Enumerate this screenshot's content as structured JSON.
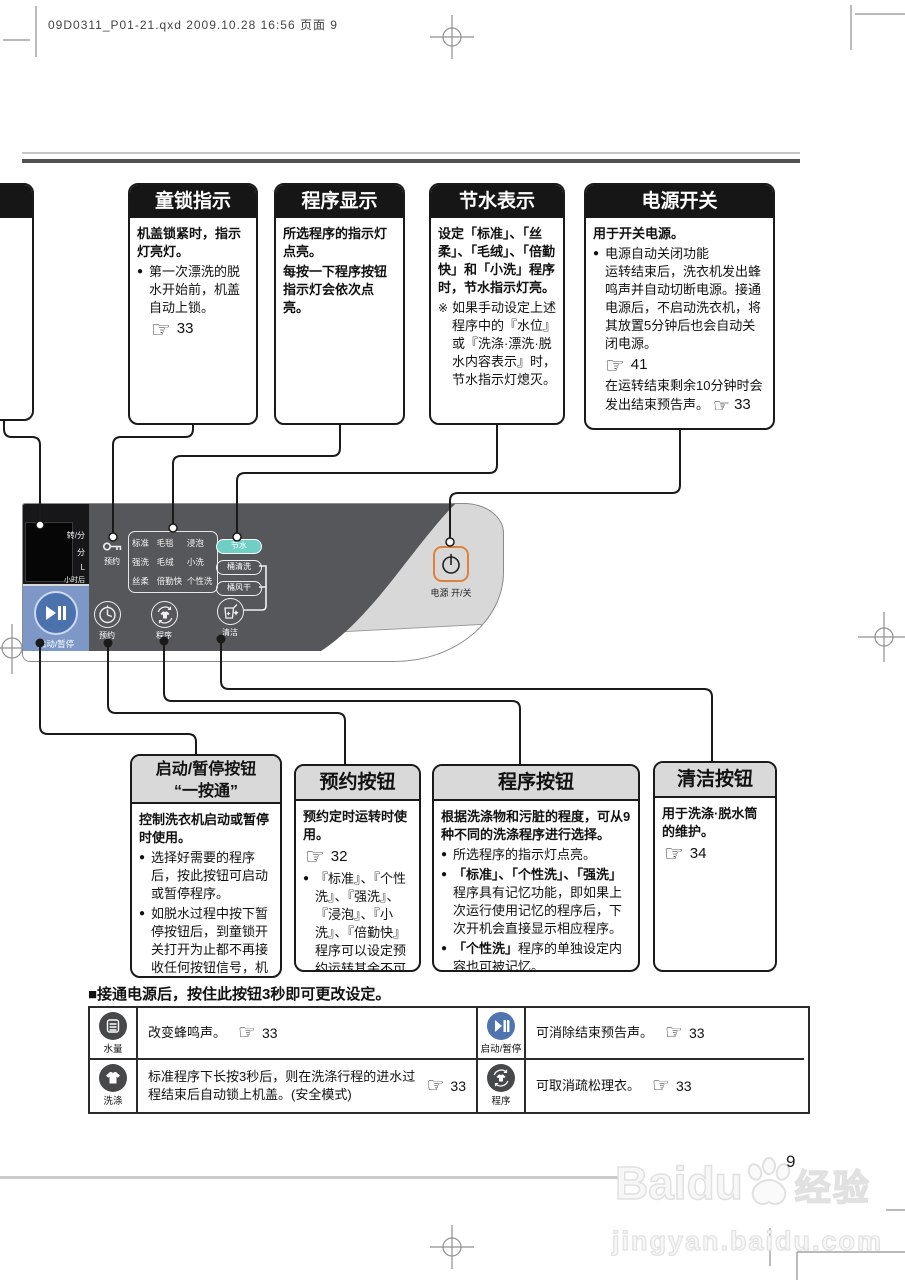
{
  "header": {
    "file_info": "09D0311_P01-21.qxd  2009.10.28  16:56  页面 9"
  },
  "icons": {
    "hand": "☞",
    "bullet": "●",
    "note": "※"
  },
  "colors": {
    "header_black": "#161616",
    "panel_dark": "#56575a",
    "panel_blue": "#7d98c7",
    "start_button_blue": "#4c72ae",
    "water_saving_teal": "#6fcfc4",
    "power_switch_orange": "#e0813a"
  },
  "top_boxes": [
    {
      "title": "童锁指示",
      "intro": "机盖锁紧时，指示灯亮灯。",
      "bullet": "第一次漂洗的脱水开始前，机盖自动上锁。",
      "ref": "33"
    },
    {
      "title": "程序显示",
      "line1": "所选程序的指示灯点亮。",
      "line2": "每按一下程序按钮指示灯会依次点亮。"
    },
    {
      "title": "节水表示",
      "intro": "设定「标准」、「丝柔」、「毛绒」、「倍勤快」和「小洗」程序时，节水指示灯亮。",
      "note": "如果手动设定上述程序中的『水位』或『洗涤·漂洗·脱水内容表示』时，节水指示灯熄灭。"
    },
    {
      "title": "电源开关",
      "intro": "用于开关电源。",
      "bullet_title": "电源自动关闭功能",
      "bullet_body": "运转结束后，洗衣机发出蜂鸣声并自动切断电源。接通电源后，不启动洗衣机，将其放置5分钟后也会自动关闭电源。",
      "ref1": "41",
      "tail": "在运转结束剩余10分钟时会发出结束预告声。",
      "ref2": "33"
    }
  ],
  "panel": {
    "display_labels": [
      "转/分",
      "分",
      "L",
      "小时后"
    ],
    "start_label": "启动/暂停",
    "reserve_lock_label": "预约",
    "programs": [
      "标准",
      "毛毯",
      "浸泡",
      "强洗",
      "毛绒",
      "小洗",
      "丝柔",
      "倍勤快",
      "个性洗"
    ],
    "pills": [
      "节水",
      "桶清洗",
      "桶风干"
    ],
    "buttons": [
      {
        "label": "预约"
      },
      {
        "label": "程序"
      },
      {
        "label": "清洁"
      }
    ],
    "power_label": "电源 开/关"
  },
  "bottom_boxes": [
    {
      "title_line1": "启动/暂停按钮",
      "title_line2": "“一按通”",
      "intro": "控制洗衣机启动或暂停时使用。",
      "bullets": [
        "选择好需要的程序后，按此按钮可启动或暂停程序。",
        "如脱水过程中按下暂停按钮后，到童锁开关打开为止都不再接收任何按钮信号，机盖亦不能打开，请耐心等待。"
      ]
    },
    {
      "title": "预约按钮",
      "intro": "预约定时运转时使用。",
      "ref": "32",
      "bullet": "『标准』、『个性洗』、『强洗』、『浸泡』、『小洗』、『倍勤快』程序可以设定预约运转其余不可设定。"
    },
    {
      "title": "程序按钮",
      "intro": "根据洗涤物和污脏的程度，可从9种不同的洗涤程序进行选择。",
      "bullet1": "所选程序的指示灯点亮。",
      "bullet2_bold": "「标准」、「个性洗」、「强洗」",
      "bullet2_rest": "程序具有记忆功能，即如果上次运行使用记忆的程序后，下次开机会直接显示相应程序。",
      "bullet3_bold": "「个性洗」",
      "bullet3_rest": "程序的单独设定内容也可被记忆。"
    },
    {
      "title": "清洁按钮",
      "intro": "用于洗涤·脱水筒的维护。",
      "ref": "34"
    }
  ],
  "settings_section": {
    "heading": "■接通电源后，按住此按钮3秒即可更改设定。",
    "rows": [
      [
        {
          "icon": "water-level",
          "label": "水量",
          "text": "改变蜂鸣声。",
          "ref": "33"
        },
        {
          "icon": "start-pause",
          "label": "启动/暂停",
          "text": "可消除结束预告声。",
          "ref": "33"
        }
      ],
      [
        {
          "icon": "wash",
          "label": "洗涤",
          "text": "标准程序下长按3秒后，则在洗涤行程的进水过程结束后自动锁上机盖。(安全模式)",
          "ref": "33"
        },
        {
          "icon": "program",
          "label": "程序",
          "text": "可取消疏松理衣。",
          "ref": "33"
        }
      ]
    ]
  },
  "footer": {
    "page_number": "9",
    "watermark_latin": "Baidu",
    "watermark_cn": "经验",
    "watermark_url": "jingyan.baidu.com"
  }
}
